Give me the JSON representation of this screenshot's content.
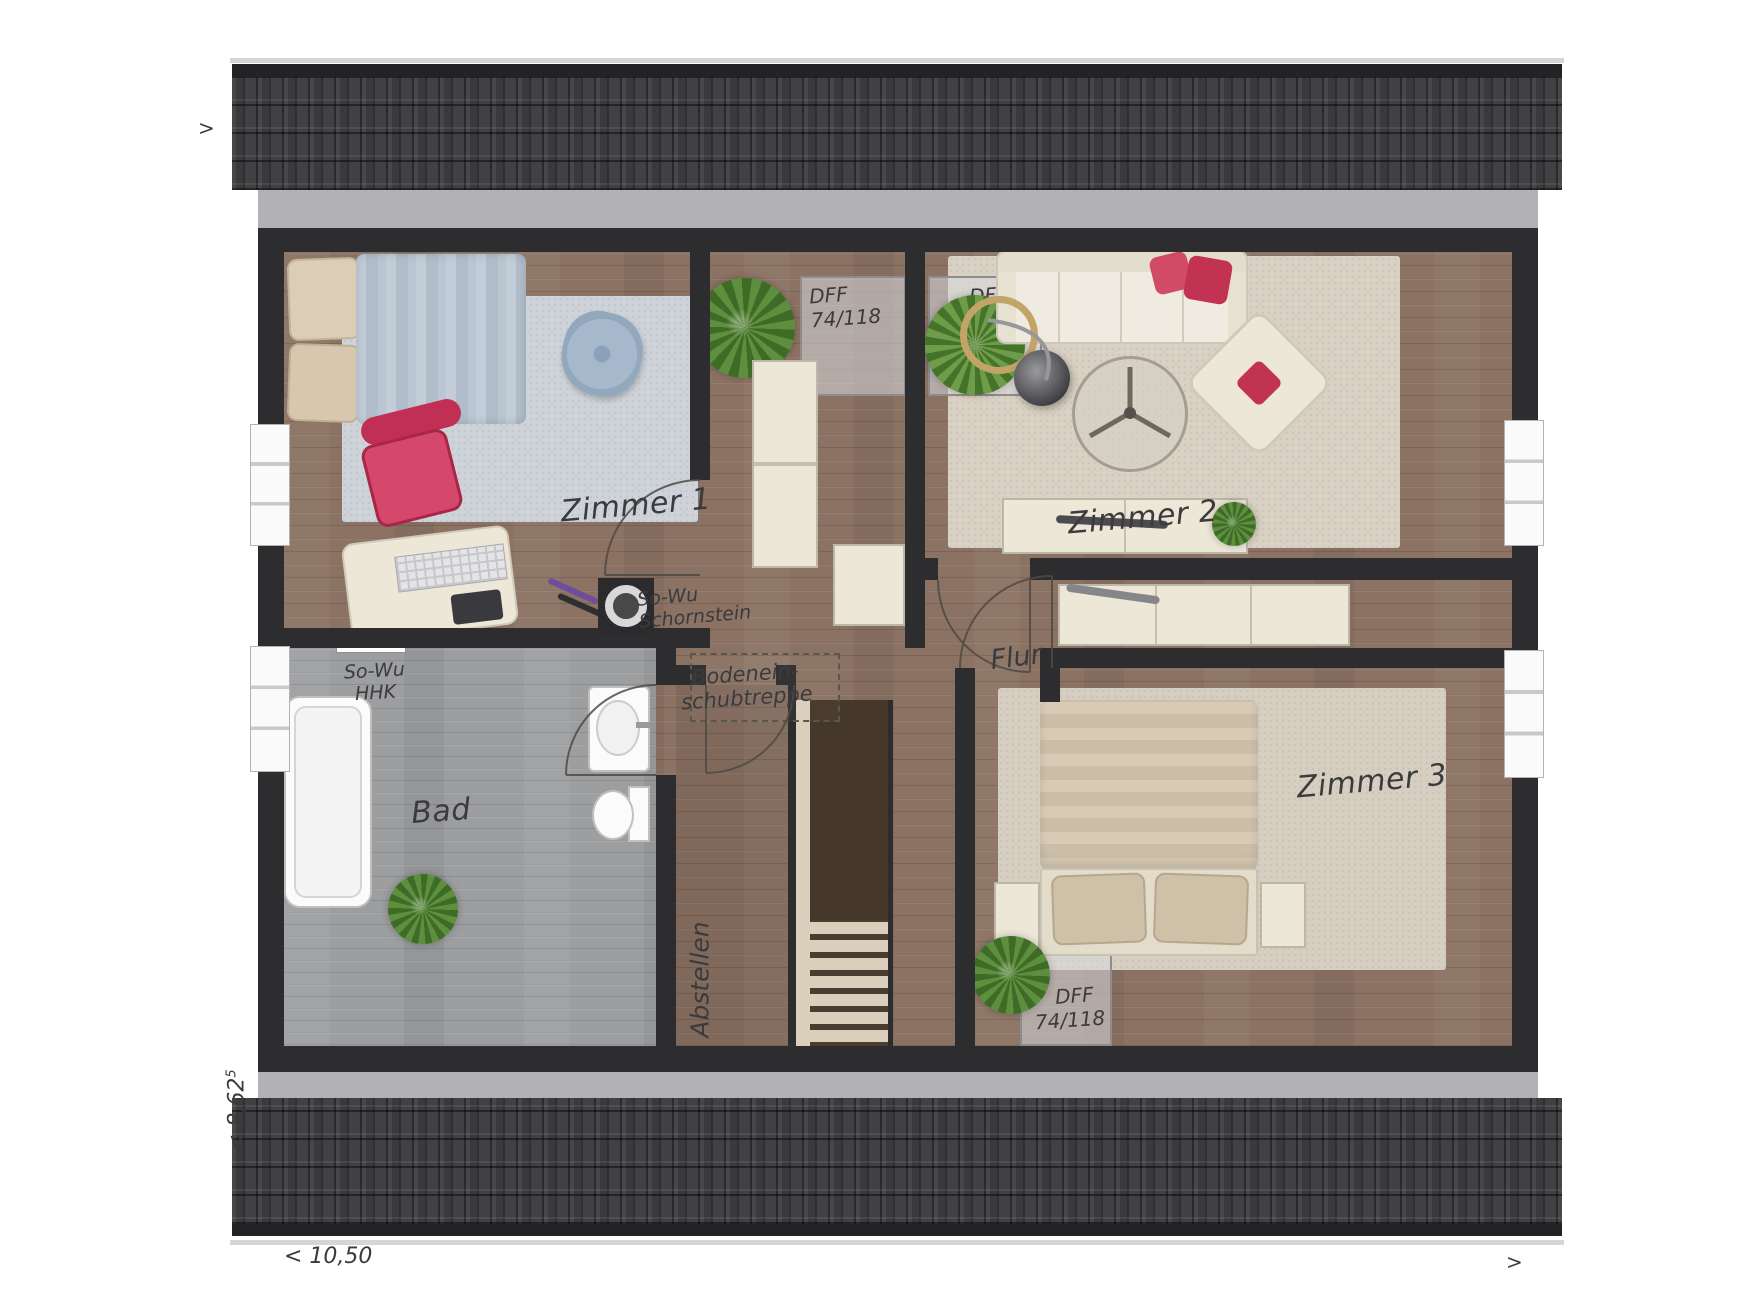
{
  "rooms": {
    "zimmer1": {
      "label": "Zimmer 1"
    },
    "zimmer2": {
      "label": "Zimmer 2"
    },
    "zimmer3": {
      "label": "Zimmer 3"
    },
    "bad": {
      "label": "Bad"
    },
    "flur": {
      "label": "Flur"
    },
    "abstellen": {
      "label": "Abstellen"
    }
  },
  "annotations": {
    "attic_hatch": {
      "line1": "Bodenein-",
      "line2": "schubtreppe"
    },
    "chimney": {
      "line1": "So-Wu",
      "line2": "Schornstein"
    },
    "radiator": {
      "line1": "So-Wu",
      "line2": "HHK"
    }
  },
  "skylights": [
    {
      "line1": "DFF",
      "line2": "74/118"
    },
    {
      "line1": "DFF",
      "line2": "74/118"
    },
    {
      "line1": "DFF",
      "line2": "74/118"
    }
  ],
  "dimensions": {
    "bottom": "< 10,50",
    "left_value": "< 8,62",
    "left_sup": "5",
    "top_left_arrow": ">",
    "bottom_right_arrow": ">"
  },
  "colors": {
    "wall": "#2d2d2f",
    "wood": "#8b7263",
    "wood_gray": "#9d9ea0",
    "rug_blue": "#cdd3d8",
    "rug_beige": "#d9d1c3",
    "accent_pink": "#c9365c",
    "furniture_cream": "#ece7d7",
    "plant_green": "#5d8f3f",
    "roof": "#39393b"
  }
}
